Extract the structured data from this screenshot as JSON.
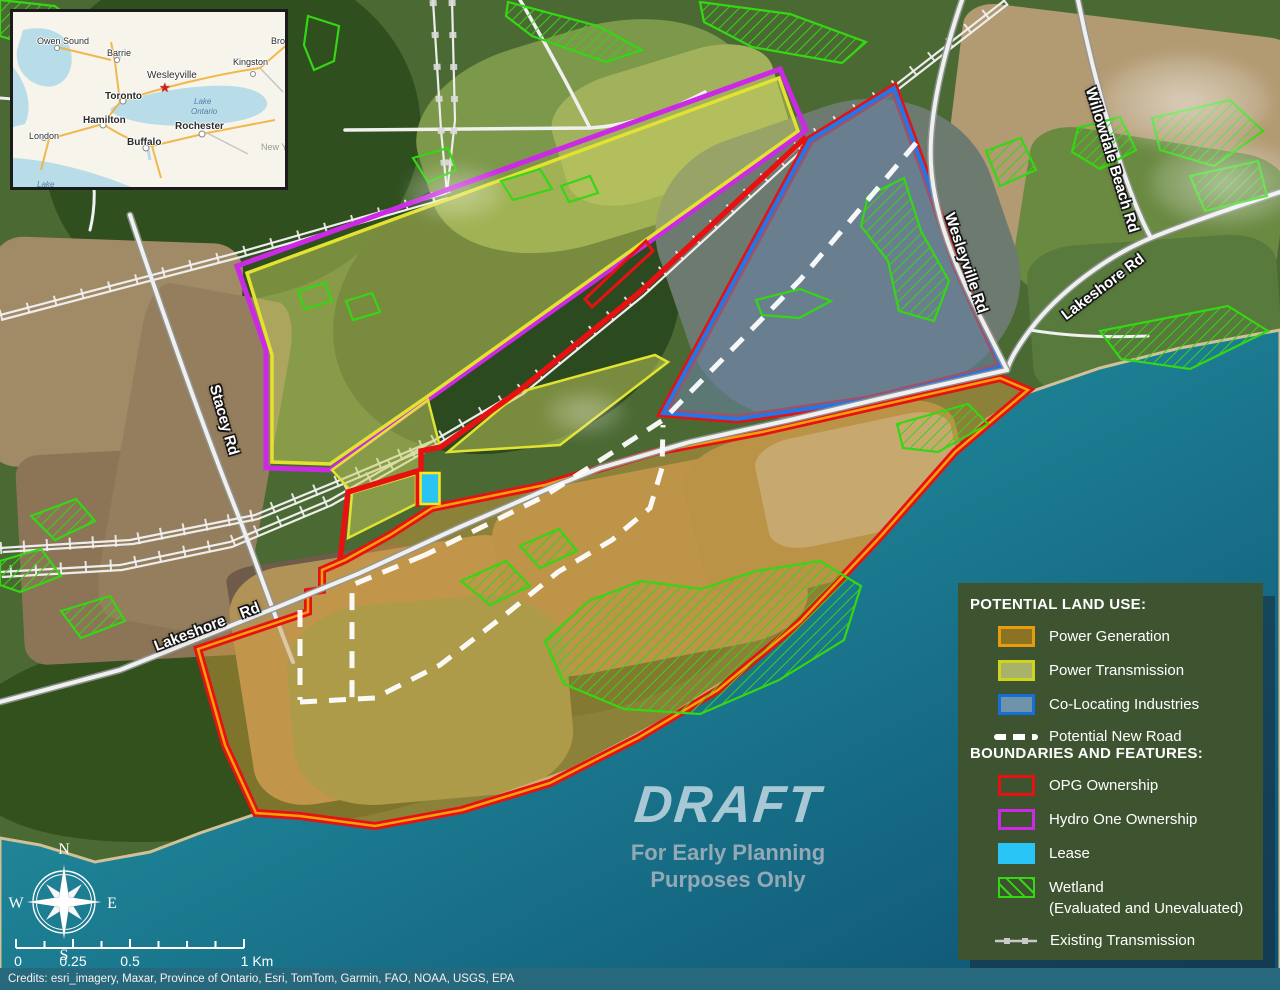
{
  "inset_map": {
    "cities": [
      {
        "label": "Owen Sound"
      },
      {
        "label": "Barrie"
      },
      {
        "label": "Kingston"
      },
      {
        "label": "Brockville"
      },
      {
        "label": "Wesleyville"
      },
      {
        "label": "Toronto"
      },
      {
        "label": "Hamilton"
      },
      {
        "label": "London"
      },
      {
        "label": "Buffalo"
      },
      {
        "label": "Rochester"
      }
    ],
    "water_labels": {
      "lake_ontario_1": "Lake",
      "lake_ontario_2": "Ontario",
      "lake_erie": "Lake"
    },
    "region_label": "New Y",
    "star_glyph": "★"
  },
  "road_labels": {
    "willowdale": "Willowdale Beach Rd",
    "lakeshore_ne": "Lakeshore Rd",
    "wesleyville": "Wesleyville Rd",
    "stacey": "Stacey Rd",
    "lakeshore_w": "Lakeshore    Rd"
  },
  "legend": {
    "land_use_title": "POTENTIAL LAND USE:",
    "land_use": [
      {
        "label": "Power Generation"
      },
      {
        "label": "Power Transmission"
      },
      {
        "label": "Co-Locating Industries"
      },
      {
        "label": "Potential New Road"
      }
    ],
    "boundaries_title": "BOUNDARIES AND FEATURES:",
    "boundaries": [
      {
        "label": "OPG Ownership"
      },
      {
        "label": "Hydro One Ownership"
      },
      {
        "label": "Lease"
      },
      {
        "label": "Wetland",
        "label2": "(Evaluated and Unevaluated)"
      },
      {
        "label": "Existing Transmission"
      }
    ]
  },
  "watermark": {
    "title": "DRAFT",
    "sub1": "For Early Planning",
    "sub2": "Purposes Only"
  },
  "compass": {
    "n": "N",
    "e": "E",
    "s": "S",
    "w": "W"
  },
  "scale_bar": {
    "labels": [
      "0",
      "0.25",
      "0.5",
      "1 Km"
    ]
  },
  "credits": "Credits:  esri_imagery, Maxar, Province of Ontario, Esri, TomTom, Garmin, FAO, NOAA, USGS, EPA",
  "colors": {
    "opg_red": "#e81111",
    "hydro_purple": "#cb29e6",
    "lease_cyan": "#29c5f6",
    "lease_border": "#ffe816",
    "wetland_green": "#35d613",
    "generation_border": "#e89c0c",
    "generation_fill": "#8a7423",
    "transmission_border": "#ccd41c",
    "transmission_fill": "#a9b26a",
    "colocating_border": "#1470d8",
    "colocating_fill": "#6f93a8",
    "potential_road": "#ffffff",
    "water_teal": "#1d7f93",
    "legend_bg": "#3e5430"
  }
}
